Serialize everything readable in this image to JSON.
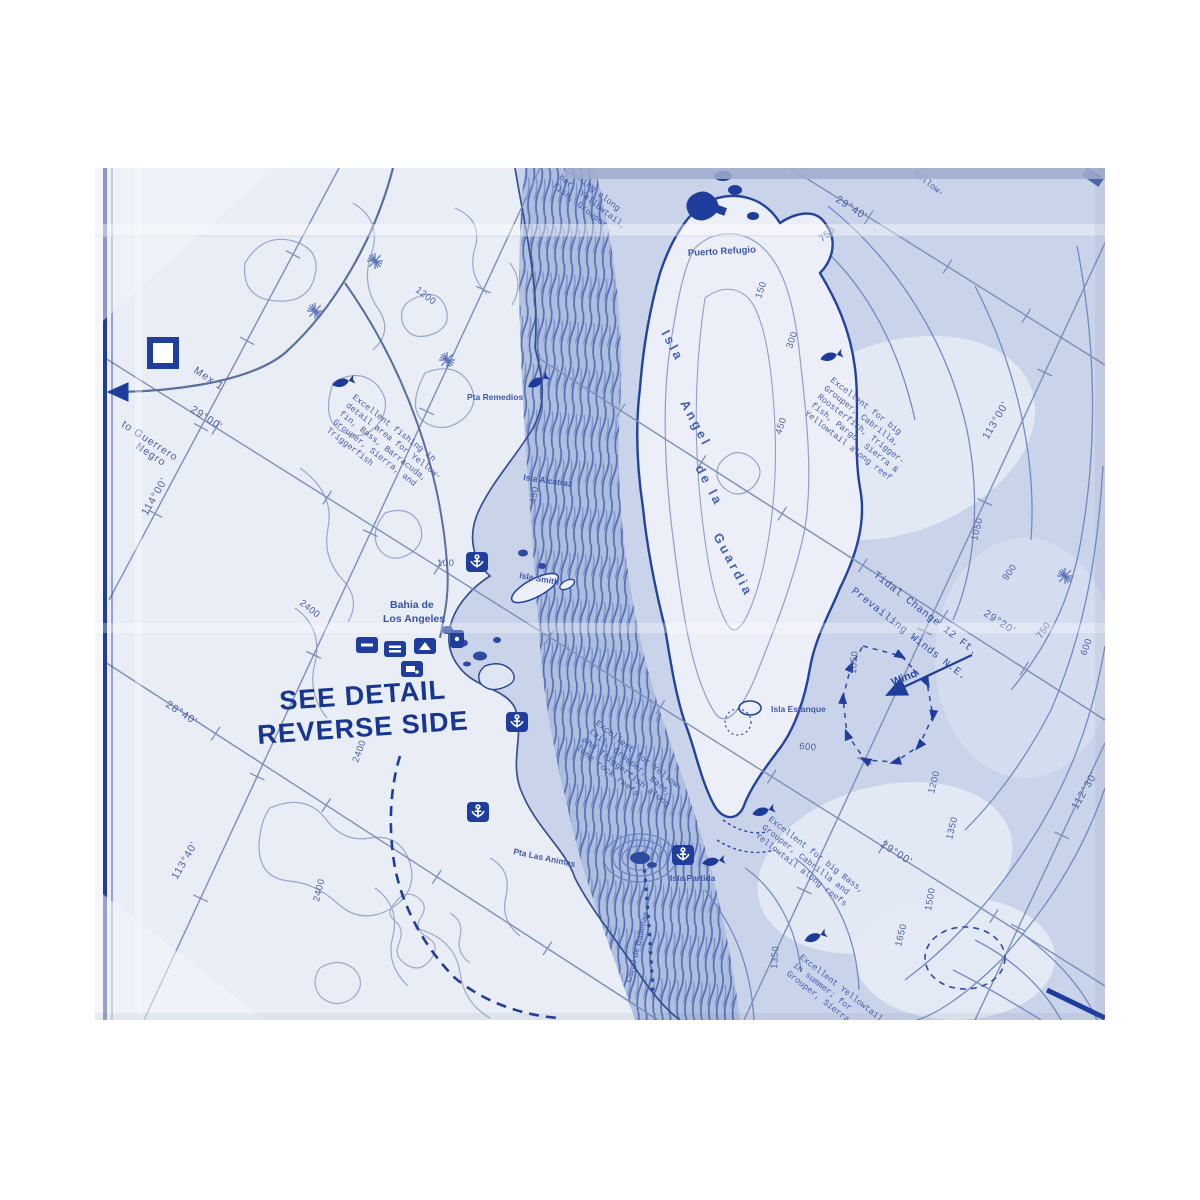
{
  "map_notice": {
    "line1": "SEE DETAIL",
    "line2": "REVERSE SIDE"
  },
  "places": {
    "puerto_refugio": "Puerto Refugio",
    "pta_remedios": "Pta Remedios",
    "isla_alcatraz": "Isla Alcatraz",
    "isla_smith": "Isla Smith",
    "bahia_line1": "Bahia de",
    "bahia_line2": "Los Angeles",
    "isla_estanque": "Isla Estanque",
    "isla_partida": "Isla Partida",
    "pta_las_animas": "Pta Las Animas",
    "canal_ballenas": "Canal de Ballenas",
    "island_word1": "Isla",
    "island_word2": "Angel",
    "island_word3": "de la",
    "island_word4": "Guardia",
    "to_guerrero_line1": "to Guerrero",
    "to_guerrero_line2": "Negro",
    "mex_1": "Mex 1"
  },
  "annotations": {
    "tidal_change": "Tidal Change 12 Ft.",
    "prevailing_winds": "Prevailing Winds N.E.",
    "wind": "Wind"
  },
  "coordinates": [
    {
      "label": "29°00'",
      "x": 95,
      "y": 243,
      "rot": 33
    },
    {
      "label": "114°00'",
      "x": 52,
      "y": 348,
      "rot": -60
    },
    {
      "label": "28°40'",
      "x": 70,
      "y": 538,
      "rot": 33
    },
    {
      "label": "113°40'",
      "x": 82,
      "y": 712,
      "rot": -60
    },
    {
      "label": "29°40'",
      "x": 740,
      "y": 33,
      "rot": 33
    },
    {
      "label": "29°20'",
      "x": 888,
      "y": 447,
      "rot": 33
    },
    {
      "label": "113°00'",
      "x": 893,
      "y": 272,
      "rot": -60
    },
    {
      "label": "29°00'",
      "x": 785,
      "y": 678,
      "rot": 33
    },
    {
      "label": "112°30'",
      "x": 982,
      "y": 642,
      "rot": -60
    }
  ],
  "contour_depths": [
    {
      "t": "750",
      "x": 727,
      "y": 74,
      "r": -38
    },
    {
      "t": "150",
      "x": 666,
      "y": 131,
      "r": -72
    },
    {
      "t": "300",
      "x": 697,
      "y": 181,
      "r": -72
    },
    {
      "t": "450",
      "x": 686,
      "y": 267,
      "r": -72
    },
    {
      "t": "450",
      "x": 441,
      "y": 336,
      "r": -82
    },
    {
      "t": "1200",
      "x": 320,
      "y": 123,
      "r": 38
    },
    {
      "t": "2400",
      "x": 204,
      "y": 436,
      "r": 38
    },
    {
      "t": "2400",
      "x": 263,
      "y": 595,
      "r": -70
    },
    {
      "t": "2400",
      "x": 224,
      "y": 734,
      "r": -76
    },
    {
      "t": "100",
      "x": 342,
      "y": 398,
      "r": 0
    },
    {
      "t": "900",
      "x": 912,
      "y": 413,
      "r": -55
    },
    {
      "t": "1050",
      "x": 882,
      "y": 373,
      "r": -76
    },
    {
      "t": "750",
      "x": 946,
      "y": 471,
      "r": -55
    },
    {
      "t": "600",
      "x": 991,
      "y": 488,
      "r": -70
    },
    {
      "t": "1050",
      "x": 761,
      "y": 506,
      "r": -86
    },
    {
      "t": "600",
      "x": 704,
      "y": 581,
      "r": 5
    },
    {
      "t": "1200",
      "x": 839,
      "y": 626,
      "r": -76
    },
    {
      "t": "1350",
      "x": 857,
      "y": 672,
      "r": -76
    },
    {
      "t": "1500",
      "x": 836,
      "y": 743,
      "r": -80
    },
    {
      "t": "1650",
      "x": 806,
      "y": 779,
      "r": -76
    },
    {
      "t": "1350",
      "x": 682,
      "y": 801,
      "r": -86
    }
  ],
  "fishing_notes": [
    {
      "x": 257,
      "y": 230,
      "rot": 38,
      "lines": [
        "Excellent fishing in",
        "detail area for Yellow-",
        "fin, Bass, Barracuda,",
        "Grouper, Sierra, and",
        "Triggerfish"
      ]
    },
    {
      "x": 735,
      "y": 213,
      "rot": 38,
      "lines": [
        "Excellent for big",
        "Grouper, Cabrilla,",
        "Roosterfish, Trigger-",
        "fish, Pargo, Sierra &",
        "Yellowtail along reef"
      ]
    },
    {
      "x": 500,
      "y": 556,
      "rot": 38,
      "lines": [
        "Excellent for Yellow-",
        "tail, Grouper, Bass,",
        "and Triggerfish along",
        "lone rock reefs"
      ]
    },
    {
      "x": 673,
      "y": 652,
      "rot": 38,
      "lines": [
        "Excellent for big Bass,",
        "Grouper, Cabrilla and",
        "Yellowtail along reefs"
      ]
    },
    {
      "x": 704,
      "y": 790,
      "rot": 38,
      "lines": [
        "Excellent Yellowtail",
        "in summer; for",
        "Grouper, Sierra"
      ]
    },
    {
      "x": 470,
      "y": 2,
      "rot": 38,
      "lines": [
        "fishing along",
        "bar, Yellowtail,",
        "fish, Grouper"
      ]
    },
    {
      "x": 818,
      "y": 6,
      "rot": 38,
      "lines": [
        "Yellow-"
      ]
    }
  ],
  "icons": {
    "anchorage": "anchor-icon",
    "fishing_spot": "fish-icon",
    "town": "town-square-icon",
    "facilities": "facility-icon",
    "peak": "starburst-icon",
    "wind_arrow": "wind-arrow-icon"
  },
  "colors": {
    "ink": "#1e3c9a",
    "paper": "#e9edf6",
    "water": "#c9d4eb",
    "channel": "#9db0d8"
  }
}
